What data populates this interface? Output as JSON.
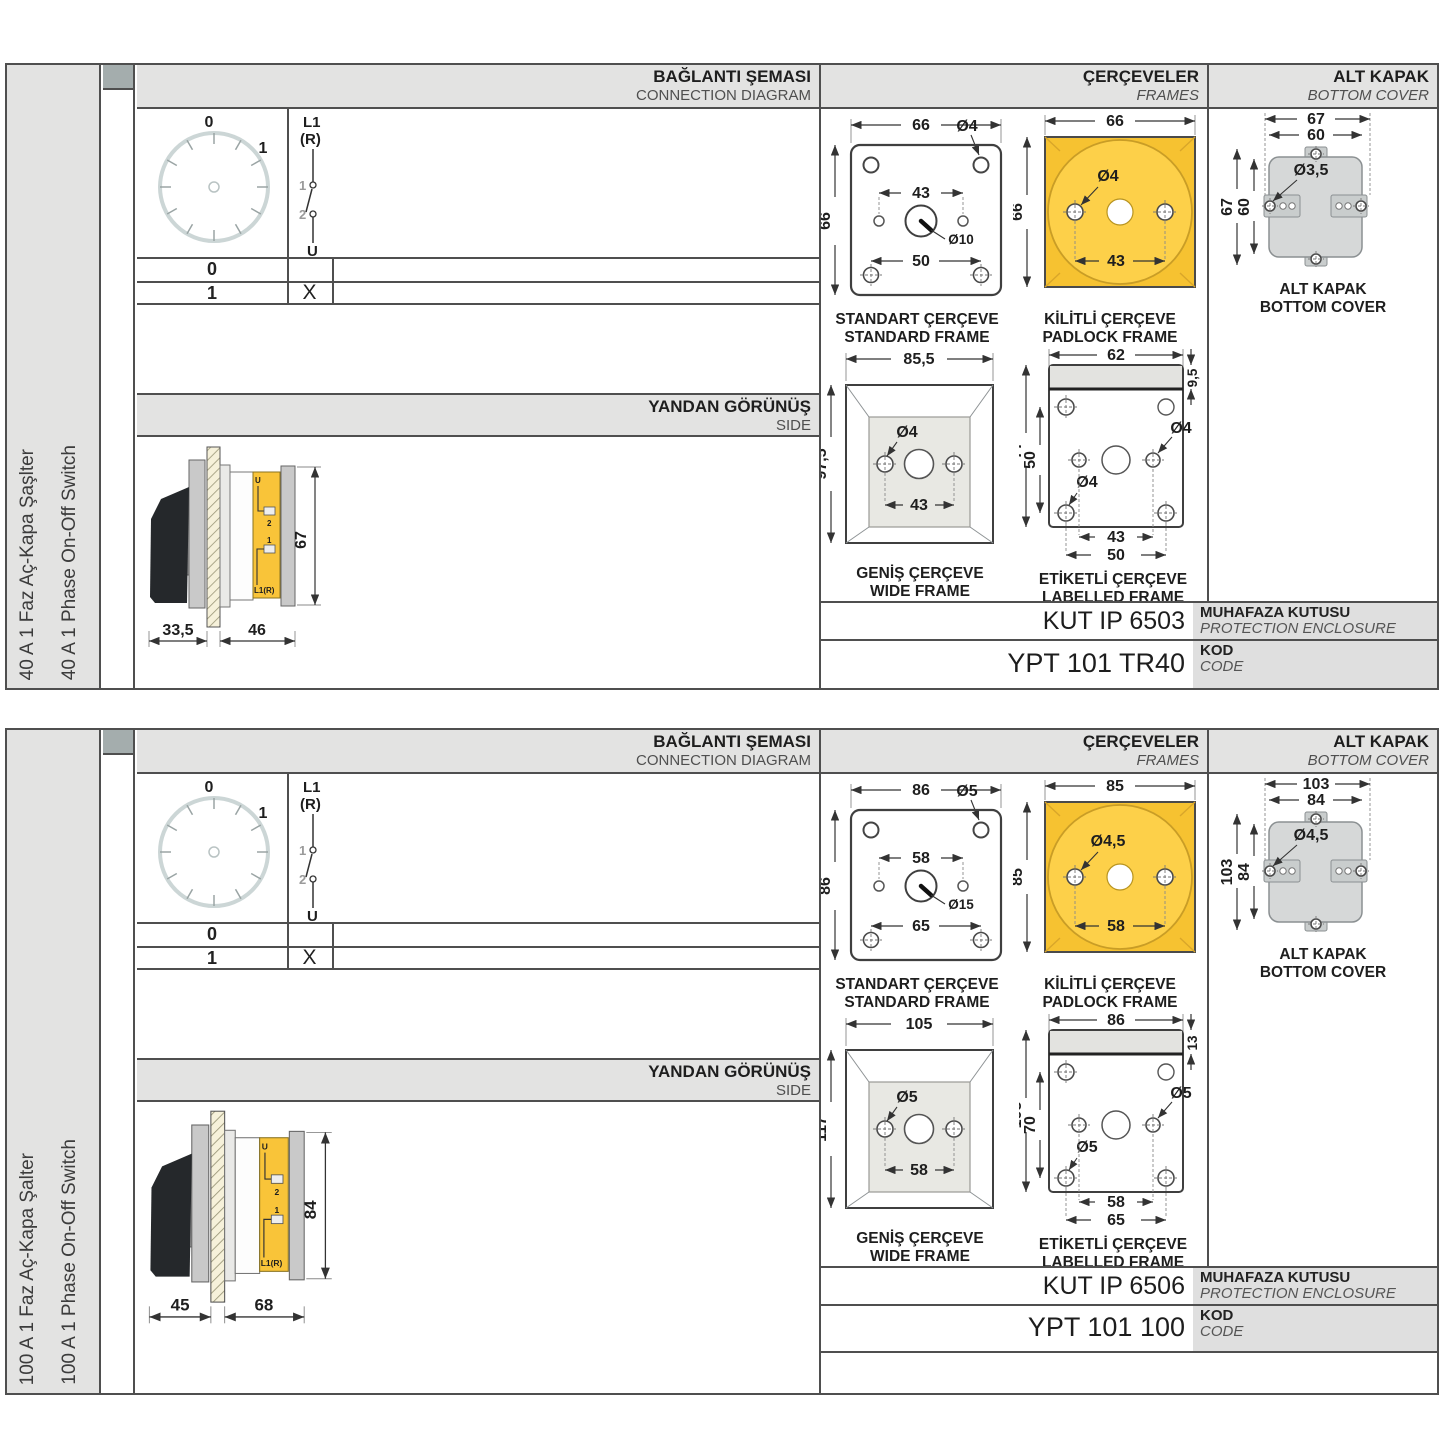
{
  "headers": {
    "connection_tr": "BAĞLANTI ŞEMASI",
    "connection_en": "CONNECTION DIAGRAM",
    "frames_tr": "ÇERÇEVELER",
    "frames_en": "FRAMES",
    "cover_tr": "ALT KAPAK",
    "cover_en": "BOTTOM COVER",
    "side_tr": "YANDAN GÖRÜNÜŞ",
    "side_en": "SIDE",
    "enclosure_tr": "MUHAFAZA KUTUSU",
    "enclosure_en": "PROTECTION ENCLOSURE",
    "code_tr": "KOD",
    "code_en": "CODE"
  },
  "captions": {
    "standard_tr": "STANDART ÇERÇEVE",
    "standard_en": "STANDARD FRAME",
    "padlock_tr": "KİLİTLİ ÇERÇEVE",
    "padlock_en": "PADLOCK FRAME",
    "wide_tr": "GENİŞ ÇERÇEVE",
    "wide_en": "WIDE FRAME",
    "labelled_tr": "ETİKETLİ ÇERÇEVE",
    "labelled_en": "LABELLED FRAME",
    "cover_tr": "ALT KAPAK",
    "cover_en": "BOTTOM COVER"
  },
  "diagram": {
    "pos0": "0",
    "pos1": "1",
    "l1": "L1",
    "r": "(R)",
    "c1": "1",
    "c2": "2",
    "u": "U",
    "row0": "0",
    "row1": "1",
    "mark": "X"
  },
  "side_labels": {
    "u": "U",
    "n2": "2",
    "n1": "1",
    "l1r": "L1(R)"
  },
  "rows": [
    {
      "label_tr": "40 A 1 Faz Aç-Kapa Şaşlter",
      "label_en": "40 A 1 Phase On-Off Switch",
      "side": {
        "front": "33,5",
        "back": "46",
        "height": "67"
      },
      "std": {
        "w": "66",
        "h": "66",
        "hole": "Ø4",
        "inner": "43",
        "center": "Ø10",
        "bottom": "50"
      },
      "padlock": {
        "w": "66",
        "h": "66",
        "hole": "Ø4",
        "inner": "43"
      },
      "wide": {
        "w": "85,5",
        "h": "97,5",
        "hole": "Ø4",
        "inner": "43"
      },
      "labelled": {
        "w": "62",
        "strip": "9,5",
        "h": "77",
        "inner_v": "50",
        "hole": "Ø4",
        "inner": "43",
        "outer": "50"
      },
      "cover": {
        "w_outer": "67",
        "w_inner": "60",
        "h_outer": "67",
        "h_inner": "60",
        "hole": "Ø3,5"
      },
      "codes": {
        "enclosure": "KUT IP 6503",
        "product": "YPT 101 TR40"
      }
    },
    {
      "label_tr": "100 A 1 Faz Aç-Kapa Şalter",
      "label_en": "100 A 1 Phase On-Off Switch",
      "side": {
        "front": "45",
        "back": "68",
        "height": "84"
      },
      "std": {
        "w": "86",
        "h": "86",
        "hole": "Ø5",
        "inner": "58",
        "center": "Ø15",
        "bottom": "65"
      },
      "padlock": {
        "w": "85",
        "h": "85",
        "hole": "Ø4,5",
        "inner": "58"
      },
      "wide": {
        "w": "105",
        "h": "117",
        "hole": "Ø5",
        "inner": "58"
      },
      "labelled": {
        "w": "86",
        "strip": "13",
        "h": "105",
        "inner_v": "70",
        "hole": "Ø5",
        "inner": "58",
        "outer": "65"
      },
      "cover": {
        "w_outer": "103",
        "w_inner": "84",
        "h_outer": "103",
        "h_inner": "84",
        "hole": "Ø4,5"
      },
      "codes": {
        "enclosure": "KUT IP 6506",
        "product": "YPT 101 100"
      }
    }
  ]
}
